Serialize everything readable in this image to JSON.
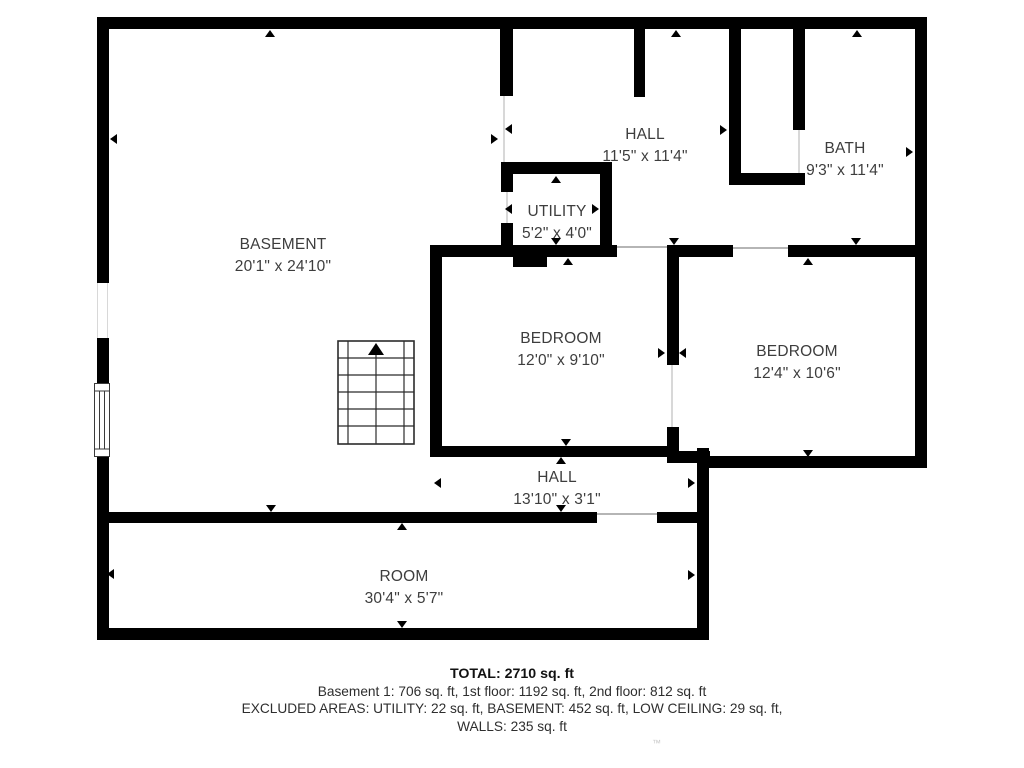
{
  "rooms": {
    "basement": {
      "name": "BASEMENT",
      "dims": "20'1\" x 24'10\""
    },
    "hall_upper": {
      "name": "HALL",
      "dims": "11'5\" x 11'4\""
    },
    "bath": {
      "name": "BATH",
      "dims": "9'3\" x 11'4\""
    },
    "utility": {
      "name": "UTILITY",
      "dims": "5'2\" x 4'0\""
    },
    "bedroom_left": {
      "name": "BEDROOM",
      "dims": "12'0\" x 9'10\""
    },
    "bedroom_right": {
      "name": "BEDROOM",
      "dims": "12'4\" x 10'6\""
    },
    "hall_lower": {
      "name": "HALL",
      "dims": "13'10\" x 3'1\""
    },
    "room": {
      "name": "ROOM",
      "dims": "30'4\" x 5'7\""
    }
  },
  "summary": {
    "total": "TOTAL: 2710 sq. ft",
    "floors": "Basement 1: 706 sq. ft, 1st floor: 1192 sq. ft, 2nd floor: 812 sq. ft",
    "excluded": "EXCLUDED AREAS: UTILITY: 22 sq. ft, BASEMENT: 452 sq. ft, LOW CEILING: 29 sq. ft,",
    "walls": "WALLS: 235 sq. ft"
  },
  "watermark": "™",
  "colors": {
    "wall": "#000000",
    "label_text": "#3d3d3d",
    "summary_text": "#2e2e2e"
  }
}
